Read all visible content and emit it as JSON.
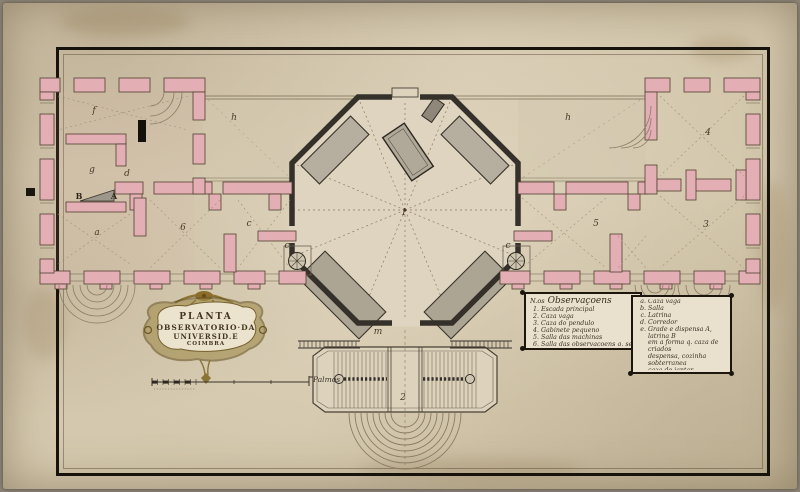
{
  "document_type": "historical architectural floor plan (manuscript, ink and wash)",
  "colors": {
    "paper": "#d6cab2",
    "wall_pink": "#e3aeb4",
    "wall_gray": "#a59e8e",
    "gallery_wash": "#b6afa0",
    "ink": "#3b3226",
    "frame": "#17120b"
  },
  "cartouche": {
    "lines": [
      "PLANTA",
      "OBSERVATORIO·DA",
      "UNIVERSID.E",
      "COIMBRA"
    ]
  },
  "scale": {
    "label": "Palmos"
  },
  "legend": {
    "heading_num": "N.os",
    "heading_word": "Observaçoens",
    "left_items": [
      {
        "k": "1.",
        "t": "Escada principal"
      },
      {
        "k": "2.",
        "t": "Caza vaga"
      },
      {
        "k": "3.",
        "t": "Caza do pendulo"
      },
      {
        "k": "4.",
        "t": "Gabinete pequeno"
      },
      {
        "k": "5.",
        "t": "Salla das machinas"
      },
      {
        "k": "6.",
        "t": "Salla das observaçoens q. se faz."
      },
      {
        "k": "7.",
        "t": "Escada p.a o q.to sobterraneo"
      }
    ],
    "right_items": [
      {
        "k": "a.",
        "t": "Caza vaga"
      },
      {
        "k": "b.",
        "t": "Salla"
      },
      {
        "k": "c.",
        "t": "Latrina"
      },
      {
        "k": "d.",
        "t": "Corredor"
      },
      {
        "k": "e.",
        "t": "Grade e dispensa A, latrina B"
      },
      {
        "k": "",
        "t": "em a forma q. caza de criados",
        "ind": true
      },
      {
        "k": "",
        "t": "despensa, cozinha sobterranea",
        "ind": true
      },
      {
        "k": "",
        "t": "caza de jantar",
        "ind": true
      },
      {
        "k": "f.",
        "t": "Caza da lenha"
      },
      {
        "k": "g.",
        "t": "Armazem p.a o carvam"
      },
      {
        "k": "h.",
        "t": "Cozinha sobterranea"
      }
    ]
  },
  "plan": {
    "labels": [
      {
        "x": 404,
        "y": 213,
        "t": "1"
      },
      {
        "x": 403,
        "y": 398,
        "t": "2"
      },
      {
        "x": 94,
        "y": 111,
        "t": "f"
      },
      {
        "x": 92,
        "y": 170,
        "t": "g"
      },
      {
        "x": 127,
        "y": 174,
        "t": "d"
      },
      {
        "x": 234,
        "y": 118,
        "t": "h"
      },
      {
        "x": 568,
        "y": 118,
        "t": "h"
      },
      {
        "x": 708,
        "y": 133,
        "t": "4"
      },
      {
        "x": 596,
        "y": 224,
        "t": "5"
      },
      {
        "x": 706,
        "y": 225,
        "t": "3"
      },
      {
        "x": 97,
        "y": 233,
        "t": "a"
      },
      {
        "x": 183,
        "y": 228,
        "t": "6"
      },
      {
        "x": 249,
        "y": 224,
        "t": "c"
      },
      {
        "x": 287,
        "y": 246,
        "t": "c"
      },
      {
        "x": 508,
        "y": 246,
        "t": "c"
      },
      {
        "x": 79,
        "y": 196,
        "t": "B",
        "b": true
      },
      {
        "x": 114,
        "y": 196,
        "t": "A",
        "b": true
      },
      {
        "x": 378,
        "y": 332,
        "t": "m"
      }
    ]
  }
}
